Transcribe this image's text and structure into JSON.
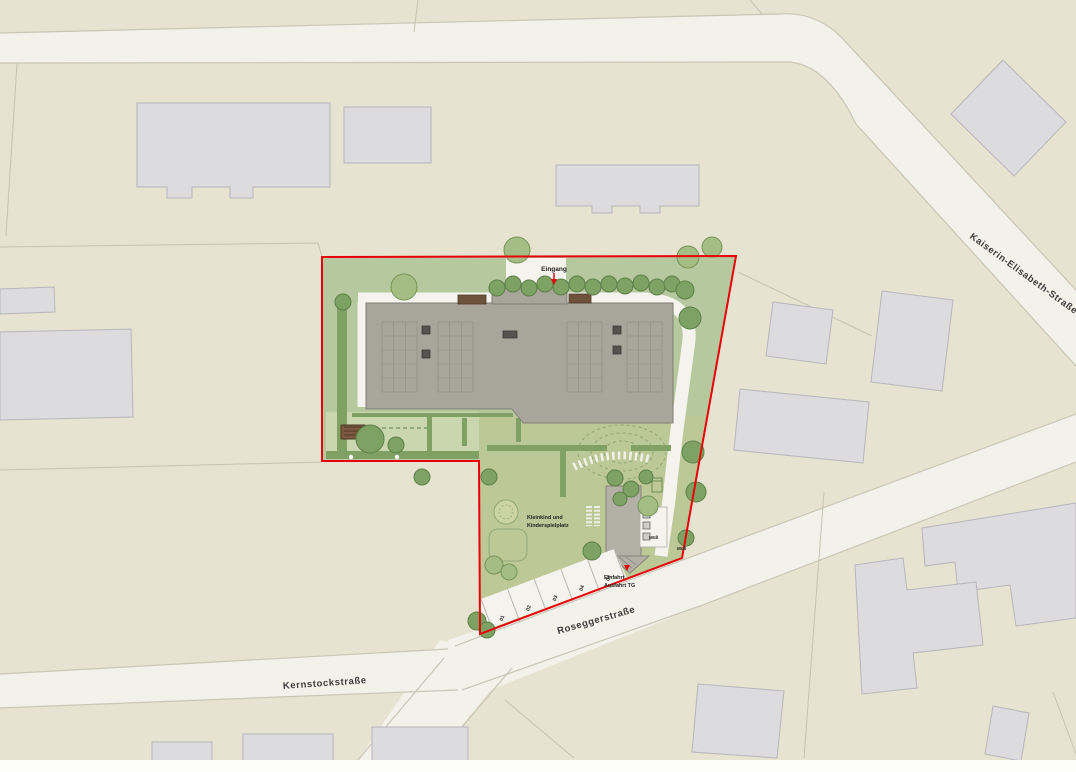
{
  "streets": {
    "kaiserin": {
      "label": "Kaiserin-Elisabeth-Straße"
    },
    "rosegger": {
      "label": "Roseggerstraße"
    },
    "kernstock": {
      "label": "Kernstockstraße"
    }
  },
  "site": {
    "entrance_label": "Eingang",
    "playground_label": {
      "line1": "Kleinkind und",
      "line2": "Kinderspielplatz"
    },
    "waste_label": "Müll",
    "waste_label_street": "Müll",
    "garage_label": {
      "line1": "Einfahrt",
      "line2": "Ausfahrt TG"
    },
    "parking_numbers": [
      "01",
      "02",
      "03",
      "04",
      "05"
    ]
  },
  "colors": {
    "background": "#e6e3d0",
    "street": "#f2f1ea",
    "street_edge": "#c9c6b5",
    "building": "#dcdbde",
    "site_green": "#b6c89e",
    "playground_green": "#bdc897",
    "lawn": "#c9d6ae",
    "hedge": "#7fa264",
    "tree_light": "#a3bd85",
    "tree_dark": "#7da263",
    "path": "#f4f3ee",
    "roof": "#a8a69a",
    "boundary_red": "#e8000b",
    "label_text": "#3c3c3c",
    "wood_brown": "#7b5a40"
  }
}
